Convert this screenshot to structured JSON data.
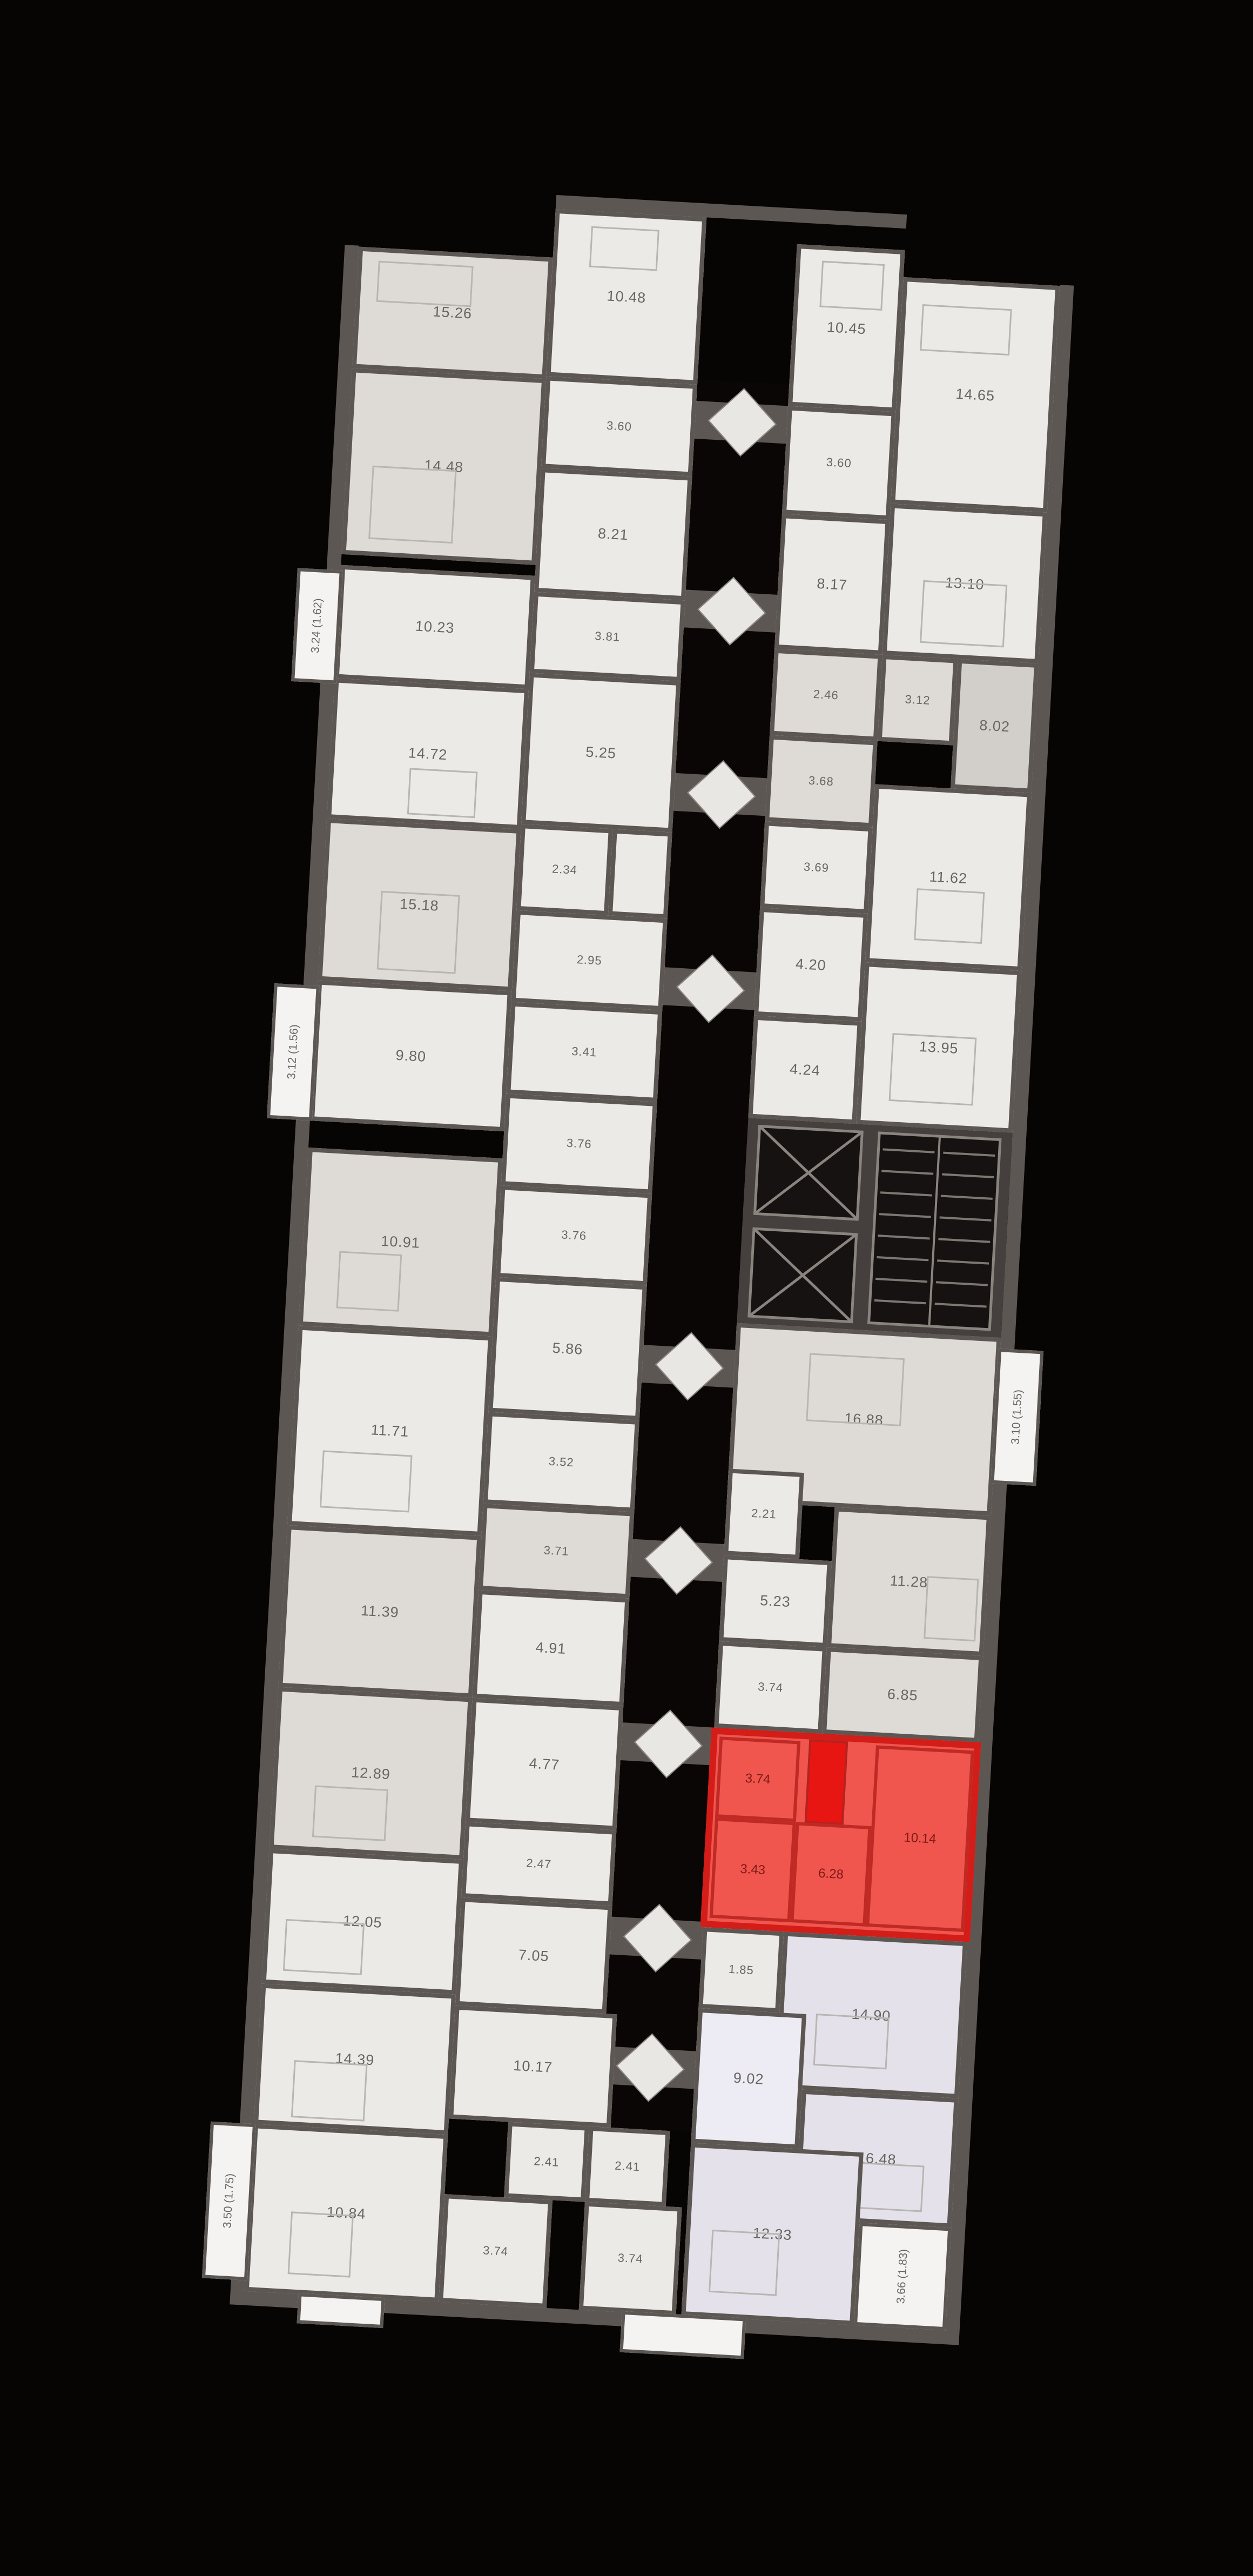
{
  "plan": {
    "type": "residential-floor-plan",
    "background_color": "#070404",
    "wall_color": "#5d5753",
    "highlight_color": "#d21d18",
    "lavender_section_color": "#e4e1eb"
  },
  "areas": {
    "r1": "15.26",
    "r2": "10.48",
    "r3": "3.60",
    "r4": "8.21",
    "r5": "14.48",
    "r6": "10.45",
    "r7": "14.65",
    "r8": "3.60",
    "r9": "8.17",
    "r10": "13.10",
    "r11": "10.23",
    "r12": "3.81",
    "r13": "5.25",
    "r14": "14.72",
    "r15": "2.34",
    "r16": "2.46",
    "r17": "3.12",
    "r18": "8.02",
    "r19": "3.68",
    "r20": "3.69",
    "r21": "11.62",
    "r22": "4.20",
    "r23": "13.95",
    "r24": "4.24",
    "r25": "15.18",
    "r26": "2.95",
    "r27": "3.41",
    "r28": "9.80",
    "r29": "3.76",
    "r30": "10.91",
    "r31": "3.76",
    "r32": "5.86",
    "r33": "11.71",
    "r34": "3.52",
    "r35": "16.88",
    "r36": "2.21",
    "r37": "5.23",
    "r38": "11.28",
    "r39": "3.74",
    "r40": "6.85",
    "r41": "11.39",
    "r42": "3.71",
    "r43": "4.91",
    "r44": "12.89",
    "r45": "4.77",
    "r46": "1.85",
    "r47": "14.90",
    "r48": "9.02",
    "r49": "16.48",
    "r50": "2.47",
    "r51": "12.05",
    "r52": "7.05",
    "r53": "14.39",
    "r54": "10.17",
    "r55": "2.41",
    "r56": "2.41",
    "r57": "10.84",
    "r58": "3.74",
    "r59": "3.74",
    "r60": "12.33"
  },
  "balconies": {
    "b1": "3.24 (1.62)",
    "b2": "3.12 (1.56)",
    "b3": "3.10 (1.55)",
    "b4": "3.50 (1.75)",
    "b5": "3.66 (1.83)"
  },
  "highlight": {
    "status": "selected-unit",
    "rooms": {
      "h1": "3.74",
      "h2": "10.14",
      "h3": "3.43",
      "h4": "6.28"
    }
  }
}
